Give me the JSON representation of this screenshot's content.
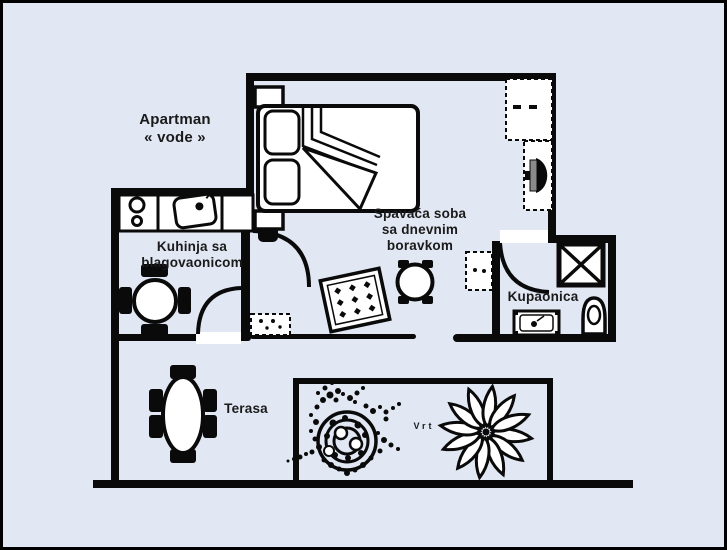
{
  "title": {
    "line1": "Apartman",
    "line2": "« vode »"
  },
  "rooms": {
    "kitchen": {
      "line1": "Kuhinja sa",
      "line2": "blagovaonicom"
    },
    "bedroom": {
      "line1": "Spavaća soba",
      "line2": "sa dnevnim",
      "line3": "boravkom"
    },
    "bathroom": {
      "label": "Kupaonica"
    },
    "terrace": {
      "label": "Terasa"
    },
    "garden": {
      "label": "Vrt"
    }
  },
  "colors": {
    "background": "#e1e7f3",
    "wall": "#0a0a0a",
    "text": "#1a1a1a",
    "tv_screen": "#8a8a8a"
  }
}
